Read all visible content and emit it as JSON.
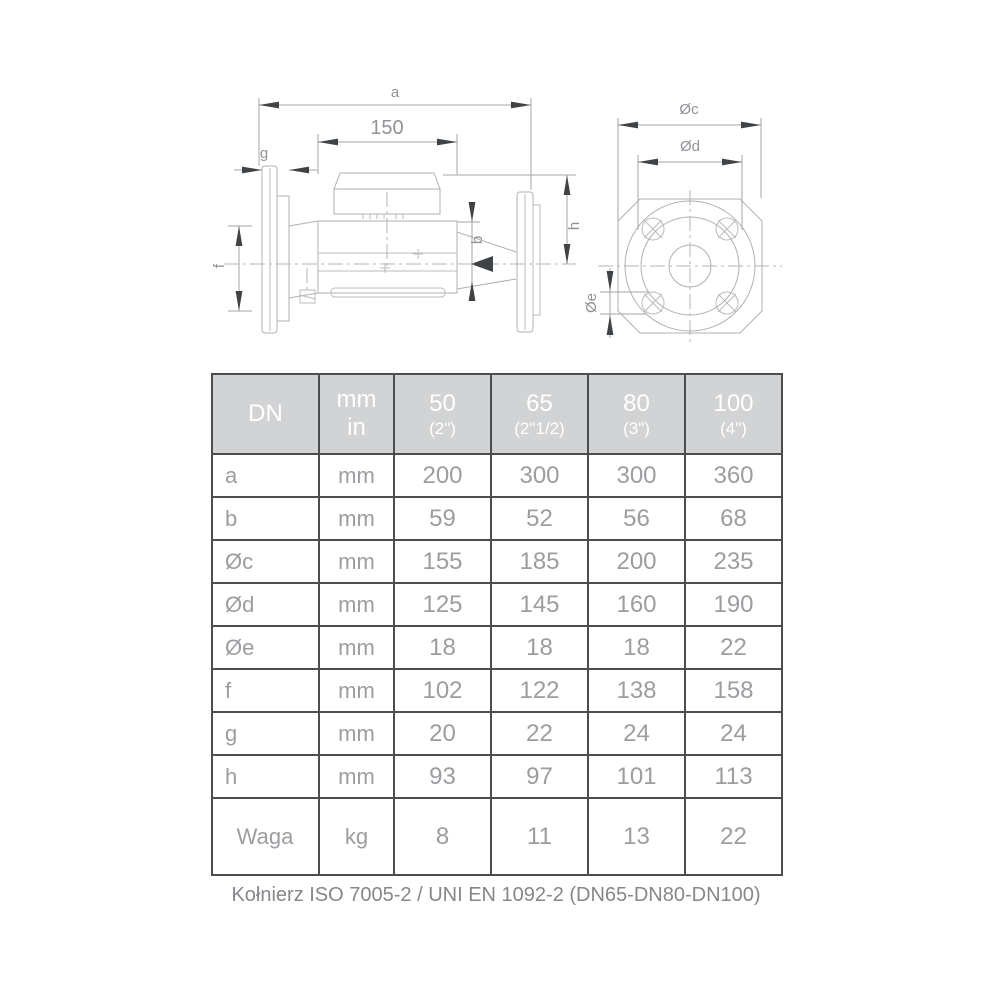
{
  "page": {
    "footer_note": "Kołnierz ISO 7005-2 / UNI EN 1092-2 (DN65-DN80-DN100)"
  },
  "colors": {
    "table_border": "#4b4d4f",
    "header_bg": "#d2d3d4",
    "header_text": "#ffffff",
    "cell_text": "#9b9da0",
    "drawing_line": "#aeb1b4",
    "drawing_arrow": "#404346",
    "drawing_label": "#8f9296"
  },
  "drawing": {
    "side_view_labels": {
      "a": "a",
      "length_150": "150",
      "g": "g",
      "b": "b",
      "h": "h",
      "f": "f"
    },
    "front_view_labels": {
      "dc": "Øc",
      "dd": "Ød",
      "de": "Øe"
    }
  },
  "table": {
    "header": {
      "dn": "DN",
      "unit_line1": "mm",
      "unit_line2": "in",
      "sizes": [
        {
          "dn": "50",
          "inch": "(2\")"
        },
        {
          "dn": "65",
          "inch": "(2\"1/2)"
        },
        {
          "dn": "80",
          "inch": "(3\")"
        },
        {
          "dn": "100",
          "inch": "(4\")"
        }
      ]
    },
    "rows": [
      {
        "label": "a",
        "unit": "mm",
        "values": [
          "200",
          "300",
          "300",
          "360"
        ]
      },
      {
        "label": "b",
        "unit": "mm",
        "values": [
          "59",
          "52",
          "56",
          "68"
        ]
      },
      {
        "label": "Øc",
        "unit": "mm",
        "values": [
          "155",
          "185",
          "200",
          "235"
        ]
      },
      {
        "label": "Ød",
        "unit": "mm",
        "values": [
          "125",
          "145",
          "160",
          "190"
        ]
      },
      {
        "label": "Øe",
        "unit": "mm",
        "values": [
          "18",
          "18",
          "18",
          "22"
        ]
      },
      {
        "label": "f",
        "unit": "mm",
        "values": [
          "102",
          "122",
          "138",
          "158"
        ]
      },
      {
        "label": "g",
        "unit": "mm",
        "values": [
          "20",
          "22",
          "24",
          "24"
        ]
      },
      {
        "label": "h",
        "unit": "mm",
        "values": [
          "93",
          "97",
          "101",
          "113"
        ]
      },
      {
        "label": "Waga",
        "unit": "kg",
        "values": [
          "8",
          "11",
          "13",
          "22"
        ]
      }
    ]
  }
}
